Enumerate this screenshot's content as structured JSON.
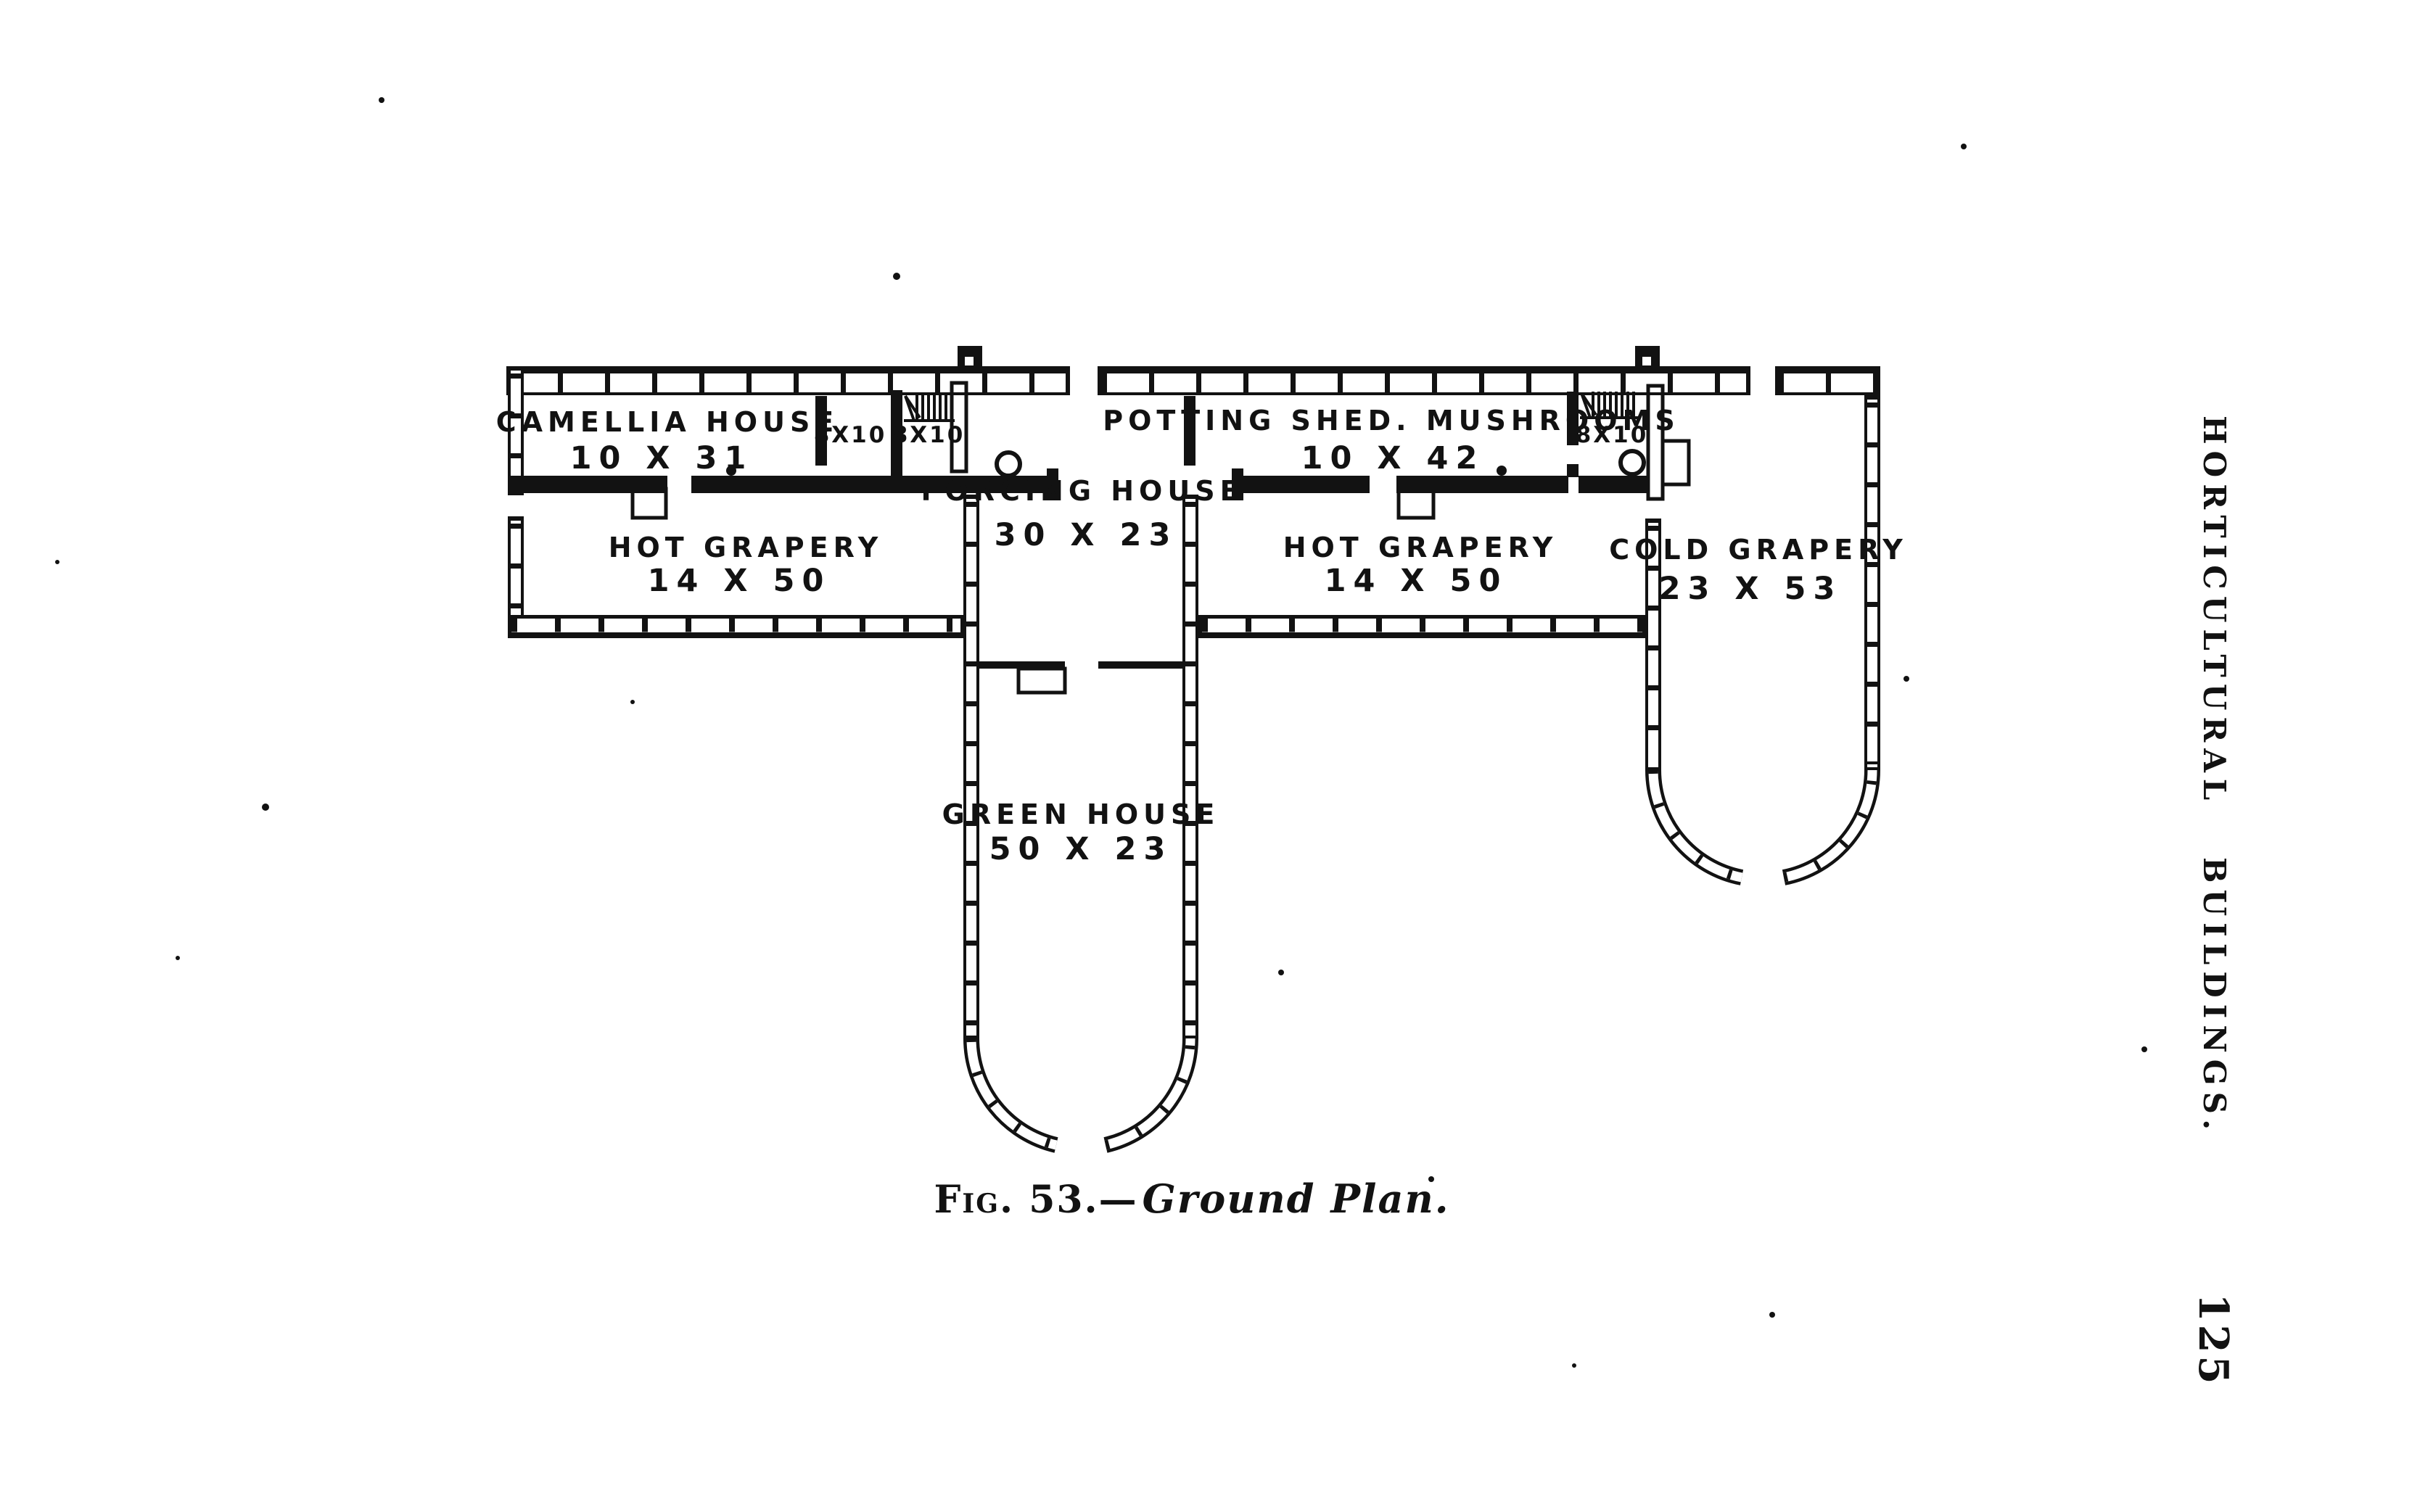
{
  "page": {
    "background": "#ffffff",
    "ink_color": "#121212",
    "margin_caption": "HORTICULTURAL BUILDINGS.",
    "page_number": "125"
  },
  "figure": {
    "caption_prefix": "Fig. 53.—",
    "caption_title": "Ground Plan."
  },
  "plan": {
    "rooms": [
      {
        "id": "camellia-house",
        "name": "CAMELLIA HOUSE",
        "dims": "10 X 31"
      },
      {
        "id": "small-room-1",
        "name": "8X10",
        "dims": ""
      },
      {
        "id": "small-room-2",
        "name": "8X10",
        "dims": ""
      },
      {
        "id": "forcing-house",
        "name": "FORCING HOUSE",
        "dims": "30 X 23"
      },
      {
        "id": "potting-shed",
        "name": "POTTING SHED. MUSHROOMS",
        "dims": "10 X 42"
      },
      {
        "id": "small-room-3",
        "name": "8X10",
        "dims": ""
      },
      {
        "id": "hot-grapery-west",
        "name": "HOT GRAPERY",
        "dims": "14 X 50"
      },
      {
        "id": "hot-grapery-east",
        "name": "HOT GRAPERY",
        "dims": "14 X 50"
      },
      {
        "id": "cold-grapery",
        "name": "COLD GRAPERY",
        "dims": "23 X 53"
      },
      {
        "id": "green-house",
        "name": "GREEN HOUSE",
        "dims": "50 X 23"
      }
    ]
  }
}
